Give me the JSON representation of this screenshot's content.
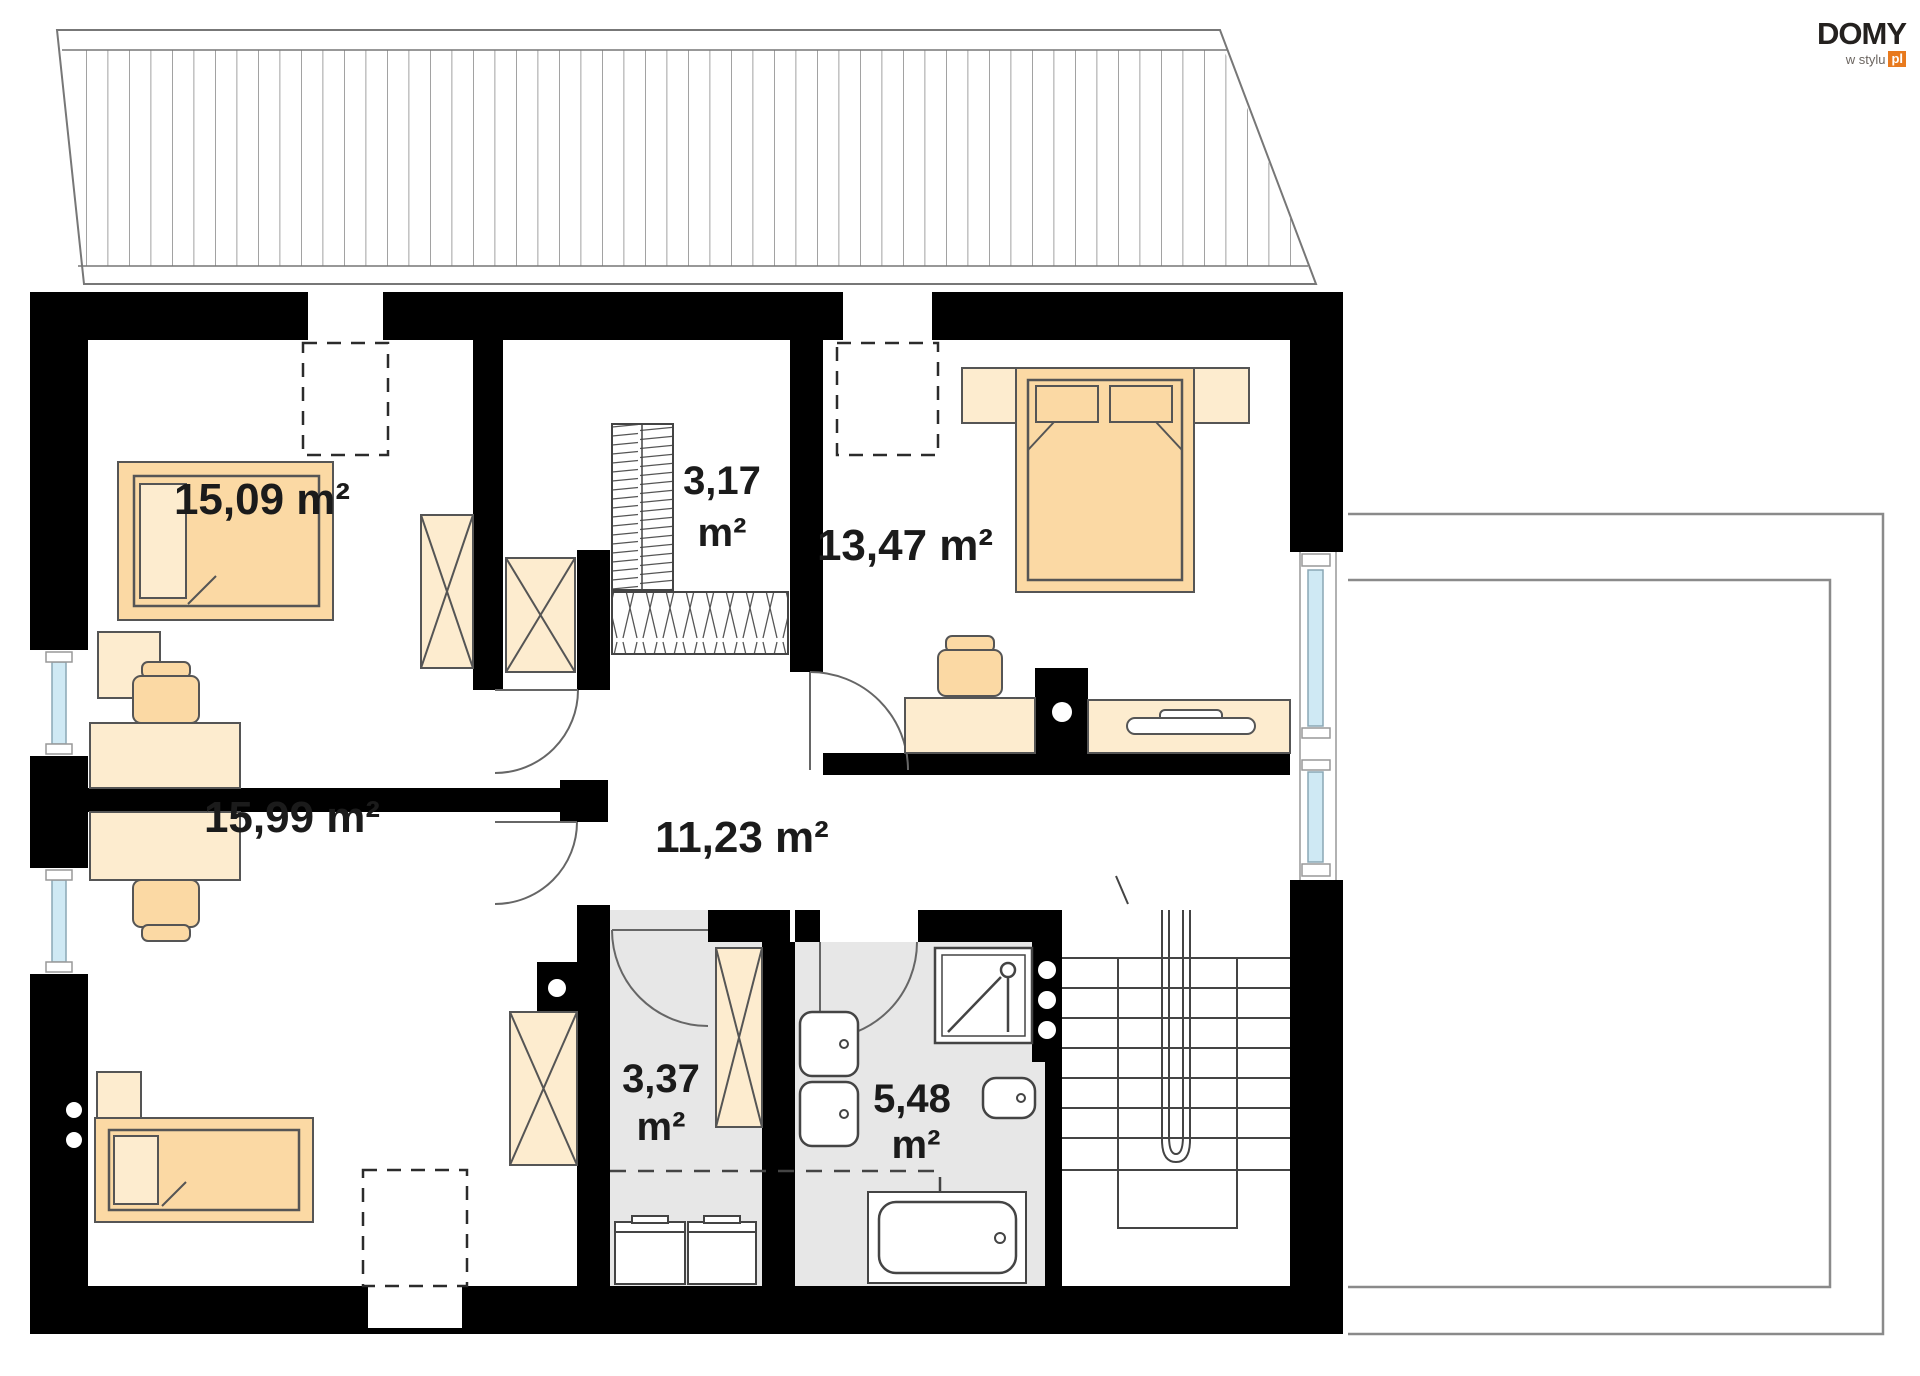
{
  "brand": {
    "name": "DOMY",
    "tagline": "w stylu",
    "tld": "pl"
  },
  "rooms": [
    {
      "name": "bedroom-top-left",
      "area": "15,09 m²"
    },
    {
      "name": "walk-in-closet",
      "area_value": "3,17",
      "area_unit": "m²"
    },
    {
      "name": "bedroom-right",
      "area": "13,47 m²"
    },
    {
      "name": "hall",
      "area": "11,23 m²"
    },
    {
      "name": "bedroom-bottom-left",
      "area": "15,99 m²"
    },
    {
      "name": "laundry",
      "area_value": "3,37",
      "area_unit": "m²"
    },
    {
      "name": "bathroom",
      "area_value": "5,48",
      "area_unit": "m²"
    }
  ],
  "colors": {
    "wall": "#000000",
    "ink": "#1b1b1b",
    "sand": "#fbd9a4",
    "sandlight": "#fdeccf",
    "floor": "#e7e7e7",
    "glass": "#cfe9f4",
    "line": "#555555",
    "thin": "#8a8a8a",
    "accent": "#e87a1e"
  }
}
